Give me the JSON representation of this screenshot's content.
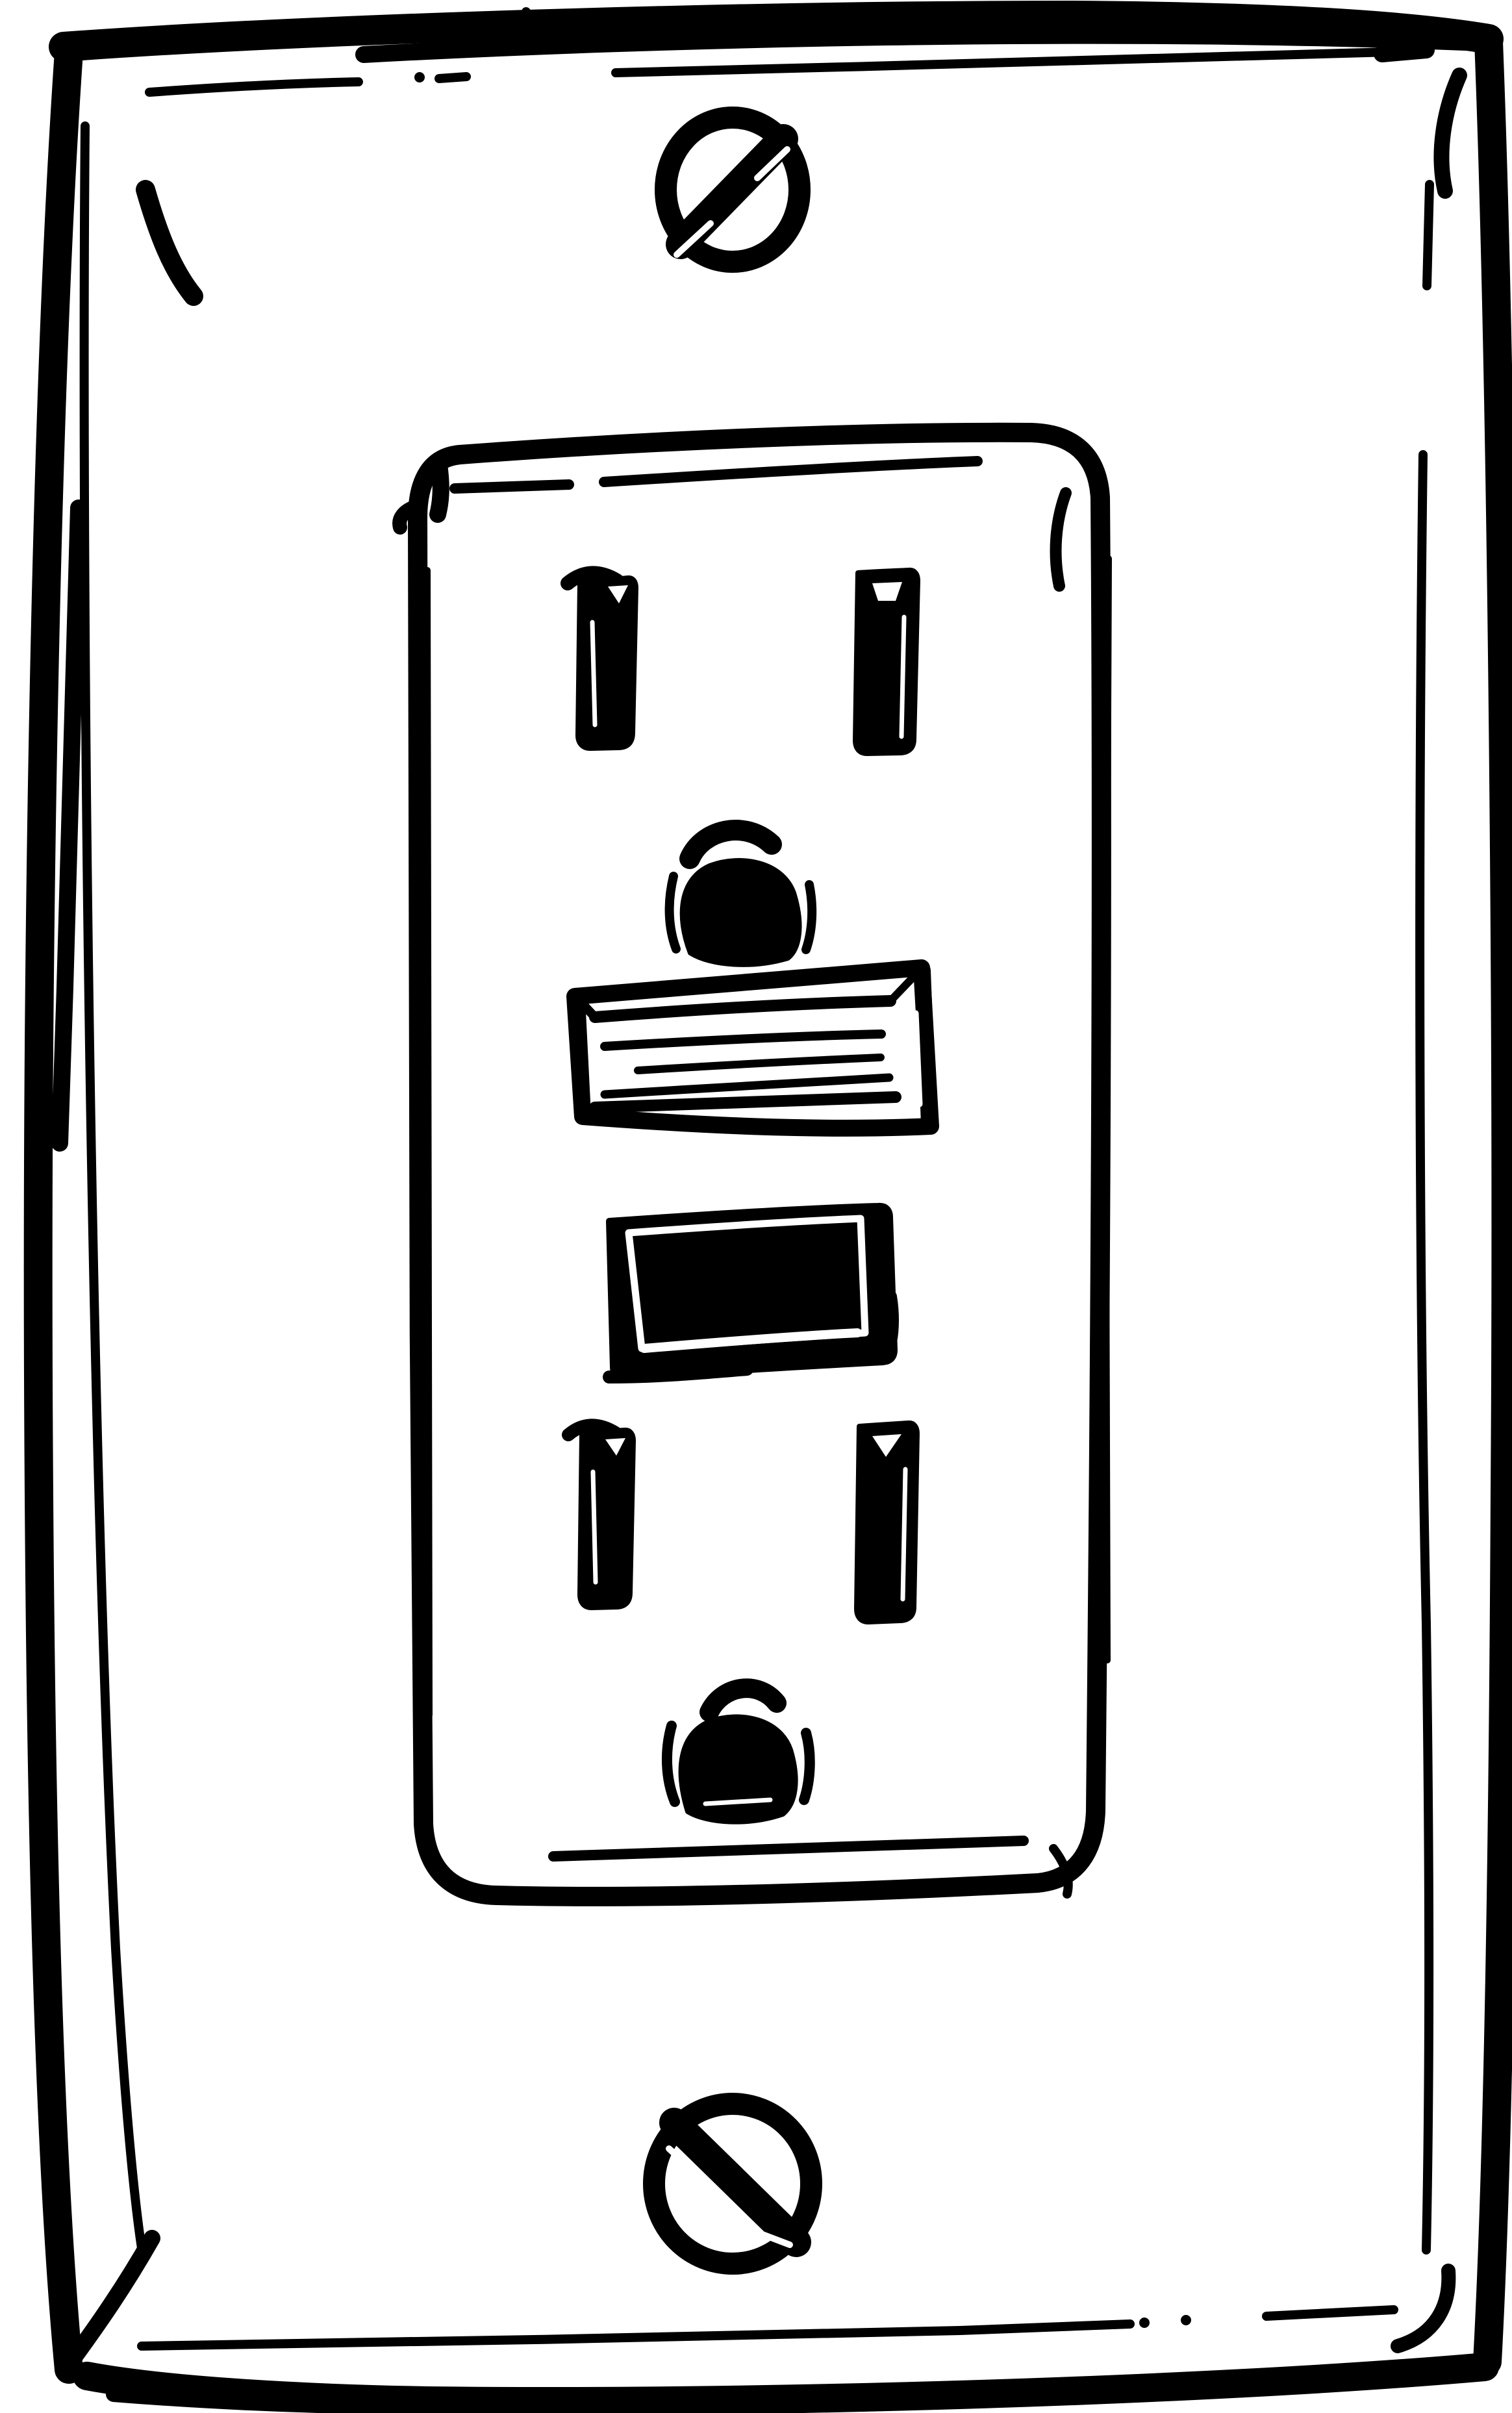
{
  "illustration": {
    "title": "Hand-drawn electrical outlet sketch",
    "description": "Black-and-white ink sketch of a GFCI duplex wall outlet: a rectangular cover plate with rounded corners and an inner bevel line, a slotted mounting screw at top and bottom, and a central rounded receptacle face containing two three-prong outlets (two vertical prong slots and a U-shaped ground hole each) flanking a beveled rectangular reset button and a solid black test button.",
    "style": "rough black marker line art on a plain white background",
    "colors": {
      "ink": "#000000",
      "background": "#ffffff",
      "highlight": "#ffffff"
    },
    "parts": [
      {
        "name": "wall-plate",
        "description": "Outer rectangular cover plate, thick irregular outline with rounded corners"
      },
      {
        "name": "plate-bevel",
        "description": "Thin inner bevel line inset from the plate edge, drawn with gaps, dots and dashes"
      },
      {
        "name": "mounting-screw-top",
        "description": "Round slotted screw head, slot angled from lower-left to upper-right"
      },
      {
        "name": "outlet-face",
        "description": "Tall rounded-rectangle receptacle face in the center of the plate"
      },
      {
        "name": "upper-receptacle",
        "description": "Upper outlet: left and right vertical prong slots above a U-shaped ground hole"
      },
      {
        "name": "reset-button",
        "description": "Wide outlined rectangular button with beveled edges and horizontal sketch lines"
      },
      {
        "name": "test-button",
        "description": "Solid black rectangular button with a white inner bevel line"
      },
      {
        "name": "lower-receptacle",
        "description": "Lower outlet: left and right vertical prong slots above a U-shaped ground hole"
      },
      {
        "name": "mounting-screw-bottom",
        "description": "Round slotted screw head, slot angled from upper-left to lower-right"
      }
    ]
  }
}
